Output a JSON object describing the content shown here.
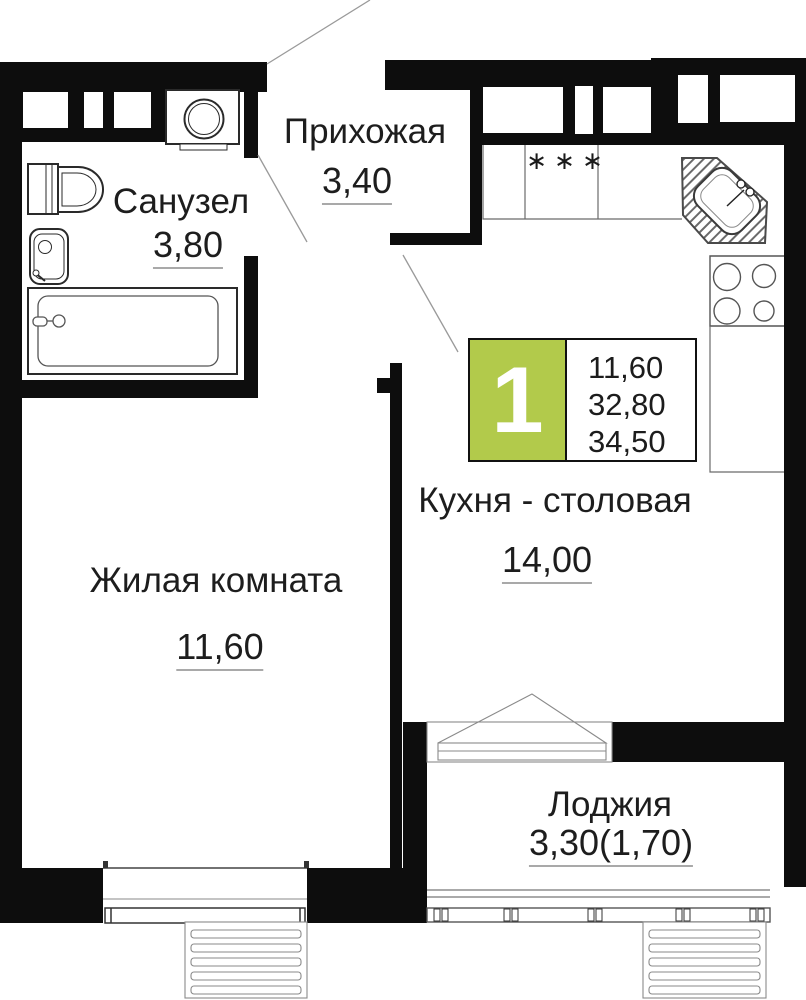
{
  "plan": {
    "badge": {
      "number": "1",
      "area_living": "11,60",
      "area_main": "32,80",
      "area_total": "34,50",
      "accent_color": "#b2ca4b"
    },
    "rooms": [
      {
        "id": "sanuzel",
        "name": "Санузел",
        "area": "3,80"
      },
      {
        "id": "prihozhaya",
        "name": "Прихожая",
        "area": "3,40"
      },
      {
        "id": "zhilaya",
        "name": "Жилая комната",
        "area": "11,60"
      },
      {
        "id": "kuhnya",
        "name": "Кухня - столовая",
        "area": "14,00"
      },
      {
        "id": "lodzhiya",
        "name": "Лоджия",
        "area": "3,30(1,70)"
      }
    ],
    "kitchen": {
      "stove_symbols": "∗∗∗"
    },
    "colors": {
      "wall": "#0d0d0d",
      "line": "#555555",
      "leader": "#999999"
    }
  }
}
